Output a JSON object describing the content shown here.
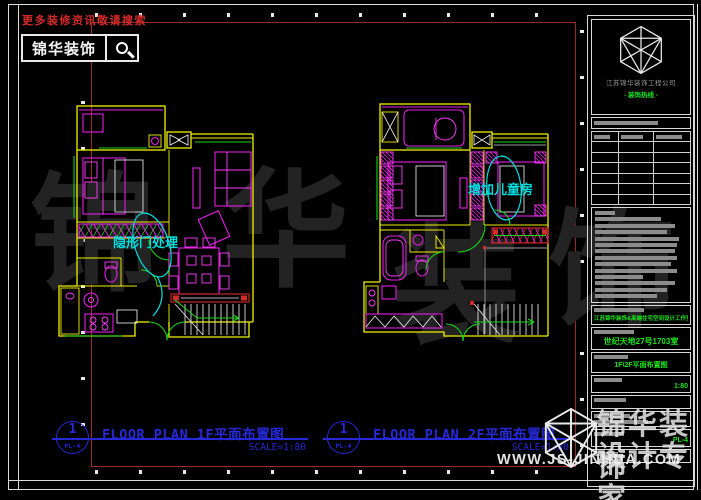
{
  "promo": {
    "text": "更多装修资讯敬请搜索"
  },
  "brand_box": {
    "label": "锦华装饰"
  },
  "plans": [
    {
      "marker_number": "1",
      "marker_ref": "PL-4",
      "title": "FLOOR PLAN 1F平面布置图",
      "scale": "SCALE=1:80",
      "annotation": "隐形门处理"
    },
    {
      "marker_number": "1",
      "marker_ref": "PL-4",
      "title": "FLOOR PLAN 2F平面布置图",
      "scale": "SCALE=1:80",
      "annotation": "增加儿童房"
    }
  ],
  "title_block": {
    "company_name": "江苏锦华装饰工程公司",
    "hotline": "- 装饰热线 -",
    "studio_line": "江苏锦华装饰&高端住宅空间设计工作室",
    "project_address": "世纪天地27号1703室",
    "drawing_title": "1F\\2F平面布置图",
    "scale": "1:80",
    "sheet_no": "PL-4"
  },
  "watermark": {
    "char_1": "锦",
    "char_2": "华",
    "char_3": "装",
    "char_4": "饰",
    "brand_line1": "锦华装饰",
    "brand_line2": "设计专家",
    "website": "WWW.JS-JINHUA.COM"
  },
  "colors": {
    "wall_yellow": "#f0f000",
    "furniture_magenta": "#e31ee3",
    "door_green": "#17d417",
    "annotation_cyan": "#00dede",
    "label_blue": "#2629d8",
    "frame_red": "#9b2727",
    "promo_red": "#d42a2a",
    "green_text": "#1ae41a"
  }
}
